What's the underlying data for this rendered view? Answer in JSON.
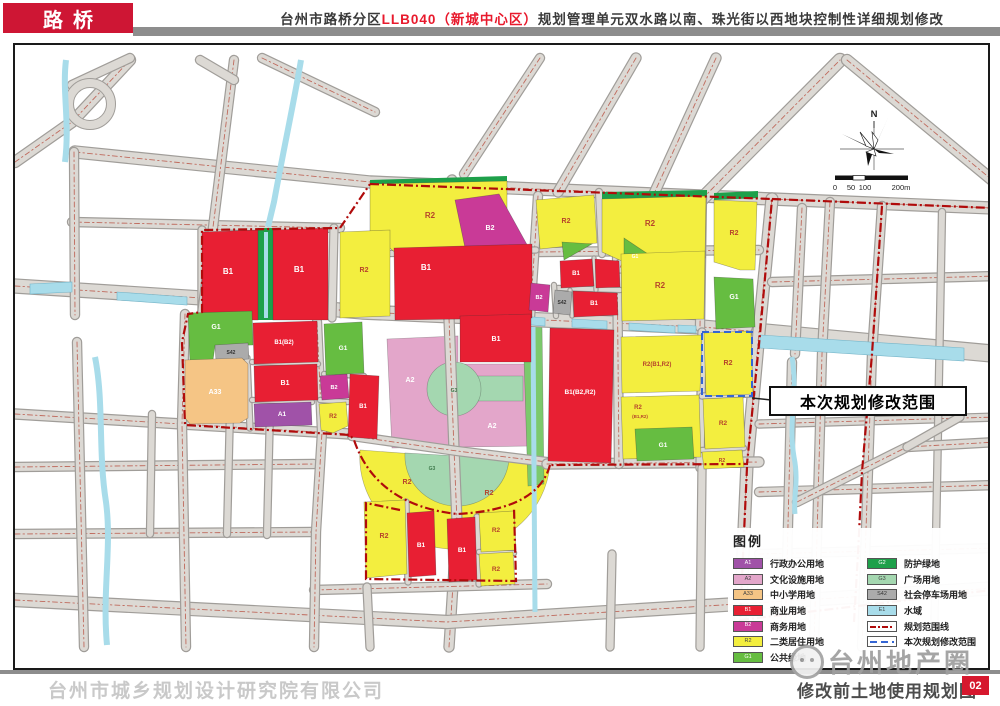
{
  "header": {
    "district": "路桥",
    "title_part1": "台州市路桥分区",
    "title_red": "LLB040（新城中心区）",
    "title_part2": "规划管理单元双水路以南、珠光街以西地块控制性详细规划修改"
  },
  "annotation": {
    "callout": "本次规划修改范围"
  },
  "compass": {
    "label": "N"
  },
  "scalebar": {
    "labels": [
      "0",
      "50",
      "100",
      "200m"
    ]
  },
  "legend": {
    "title": "图例",
    "left": [
      {
        "code": "A1",
        "label": "行政办公用地",
        "color": "#a052a8",
        "tc": "#ffffff",
        "type": "swatch"
      },
      {
        "code": "A2",
        "label": "文化设施用地",
        "color": "#e3a6ca",
        "tc": "#444444",
        "type": "swatch"
      },
      {
        "code": "A33",
        "label": "中小学用地",
        "color": "#f5c585",
        "tc": "#444444",
        "type": "swatch"
      },
      {
        "code": "B1",
        "label": "商业用地",
        "color": "#e81f33",
        "tc": "#ffffff",
        "type": "swatch"
      },
      {
        "code": "B2",
        "label": "商务用地",
        "color": "#c93a97",
        "tc": "#ffffff",
        "type": "swatch"
      },
      {
        "code": "R2",
        "label": "二类居住用地",
        "color": "#f3ee3f",
        "tc": "#444444",
        "type": "swatch"
      },
      {
        "code": "G1",
        "label": "公共绿地",
        "color": "#66bd41",
        "tc": "#ffffff",
        "type": "swatch"
      }
    ],
    "right": [
      {
        "code": "G2",
        "label": "防护绿地",
        "color": "#1ea04a",
        "tc": "#ffffff",
        "type": "swatch"
      },
      {
        "code": "G3",
        "label": "广场用地",
        "color": "#a4d7b0",
        "tc": "#444444",
        "type": "swatch"
      },
      {
        "code": "S42",
        "label": "社会停车场用地",
        "color": "#ababab",
        "tc": "#333333",
        "type": "swatch"
      },
      {
        "code": "E1",
        "label": "水域",
        "color": "#a8dcea",
        "tc": "#444444",
        "type": "swatch"
      },
      {
        "code": "",
        "label": "规划范围线",
        "color": "#ffffff",
        "tc": "#444444",
        "type": "line-red"
      },
      {
        "code": "",
        "label": "本次规划修改范围",
        "color": "#ffffff",
        "tc": "#444444",
        "type": "line-blue"
      }
    ]
  },
  "footer": {
    "company": "台州市城乡规划设计研究院有限公司",
    "watermark": "台州地产圈",
    "map_title": "修改前土地使用规划图",
    "page": "02"
  },
  "colors": {
    "A1": "#a052a8",
    "A2": "#e3a6ca",
    "A33": "#f5c585",
    "B1": "#e81f33",
    "B2": "#c93a97",
    "R2": "#f3ee3f",
    "G1": "#66bd41",
    "G2": "#1ea04a",
    "G3": "#a4d7b0",
    "S42": "#ababab",
    "E1": "#a8dcea",
    "roadFill": "#dcd9d4",
    "roadEdge": "#a09d99",
    "centerline": "#bf6a5d",
    "boundary": "#b00b0b",
    "modifyBlue": "#3465d4",
    "riverGreen": "#7cc96c"
  },
  "map": {
    "parks": [
      {
        "c": "A2",
        "pts": "385,337 456,334 456,362 529,362 529,444 390,446"
      },
      {
        "c": "G3",
        "path": "M452,374 L521,374 L521,399 L452,399 Z"
      },
      {
        "c": "G3",
        "circle": [
          452,
          387,
          27
        ]
      },
      {
        "c": "R2",
        "path": "M358,448 A95,92 0 0 0 548,462 Z"
      },
      {
        "c": "G3",
        "path": "M403,451 A52,50 0 0 0 507,457 Z"
      },
      {
        "c": "riverGreen",
        "pts": "521,325 540,323 542,482 526,484"
      }
    ],
    "roads": [
      {
        "p": "73,150 368,180 770,197 990,206",
        "w": 11,
        "cl": 1
      },
      {
        "p": "13,284 200,296 360,310 700,325 758,330",
        "w": 13,
        "cl": 1
      },
      {
        "p": "758,330 995,352",
        "w": 16,
        "cl": 0
      },
      {
        "p": "770,197 757,330 745,462 738,620",
        "w": 11,
        "cl": 1
      },
      {
        "p": "450,178 443,310",
        "w": 9,
        "cl": 1
      },
      {
        "p": "447,316 452,447 455,520 447,645",
        "w": 9,
        "cl": 1
      },
      {
        "p": "13,598 445,620 995,586",
        "w": 12,
        "cl": 1
      },
      {
        "p": "700,197 838,58",
        "w": 12,
        "cl": 1
      },
      {
        "p": "845,58 995,182",
        "w": 10,
        "cl": 1
      },
      {
        "p": "70,220 338,226",
        "w": 8,
        "cl": 1
      },
      {
        "p": "536,250 757,248",
        "w": 8,
        "cl": 1
      },
      {
        "p": "13,412 180,422 348,432",
        "w": 9,
        "cl": 1
      },
      {
        "p": "350,434 455,449 545,460",
        "w": 8,
        "cl": 1
      },
      {
        "p": "545,462 757,460",
        "w": 9,
        "cl": 1
      },
      {
        "p": "617,385 702,383",
        "w": 7,
        "cl": 1
      },
      {
        "p": "13,465 312,462",
        "w": 8,
        "cl": 1
      },
      {
        "p": "13,532 310,530",
        "w": 8,
        "cl": 1
      },
      {
        "p": "312,588 545,582",
        "w": 8,
        "cl": 1
      },
      {
        "p": "757,552 995,546",
        "w": 8,
        "cl": 1
      },
      {
        "p": "757,490 995,483",
        "w": 8,
        "cl": 1
      },
      {
        "p": "770,280 995,274",
        "w": 8,
        "cl": 1
      },
      {
        "p": "757,422 995,415",
        "w": 7,
        "cl": 1
      },
      {
        "p": "72,150 73,313",
        "w": 8,
        "cl": 1
      },
      {
        "p": "75,340 82,645",
        "w": 8,
        "cl": 1
      },
      {
        "p": "200,228 200,310",
        "w": 7,
        "cl": 0
      },
      {
        "p": "183,312 180,422 184,645",
        "w": 8,
        "cl": 1
      },
      {
        "p": "315,320 320,430 314,530 312,645",
        "w": 8,
        "cl": 1
      },
      {
        "p": "332,226 330,316",
        "w": 7,
        "cl": 0
      },
      {
        "p": "365,585 368,645",
        "w": 7,
        "cl": 0
      },
      {
        "p": "536,194 528,316",
        "w": 8,
        "cl": 1
      },
      {
        "p": "597,190 600,252",
        "w": 6,
        "cl": 0
      },
      {
        "p": "615,250 617,462",
        "w": 8,
        "cl": 1
      },
      {
        "p": "700,194 698,325",
        "w": 8,
        "cl": 1
      },
      {
        "p": "700,330 698,466",
        "w": 7,
        "cl": 0
      },
      {
        "p": "800,206 793,352",
        "w": 8,
        "cl": 1
      },
      {
        "p": "790,360 783,645",
        "w": 8,
        "cl": 1
      },
      {
        "p": "828,200 820,352 812,645",
        "w": 8,
        "cl": 1
      },
      {
        "p": "880,204 870,352 860,645",
        "w": 8,
        "cl": 1
      },
      {
        "p": "940,210 932,645",
        "w": 6,
        "cl": 0
      },
      {
        "p": "232,58 200,313",
        "w": 8,
        "cl": 1
      },
      {
        "p": "13,160 70,120 128,58",
        "w": 10,
        "cl": 1
      },
      {
        "p": "128,56 70,83",
        "w": 8,
        "cl": 0
      },
      {
        "p": "198,58 232,78",
        "w": 8,
        "cl": 0
      },
      {
        "p": "260,56 373,110",
        "w": 8,
        "cl": 1
      },
      {
        "p": "538,56 462,172",
        "w": 8,
        "cl": 1
      },
      {
        "p": "634,56 556,190",
        "w": 9,
        "cl": 1
      },
      {
        "p": "714,56 618,266",
        "w": 9,
        "cl": 1
      },
      {
        "p": "795,500 905,445 995,440",
        "w": 8,
        "cl": 1
      },
      {
        "p": "905,445 958,415",
        "w": 7,
        "cl": 0
      },
      {
        "p": "150,412 148,532",
        "w": 6,
        "cl": 0
      },
      {
        "p": "228,408 225,532",
        "w": 6,
        "cl": 0
      },
      {
        "p": "268,408 265,533",
        "w": 6,
        "cl": 0
      },
      {
        "p": "610,552 608,645",
        "w": 7,
        "cl": 0
      },
      {
        "p": "700,466 698,645",
        "w": 7,
        "cl": 0
      },
      {
        "p": "368,252 534,248",
        "w": 5,
        "cl": 0
      },
      {
        "p": "245,356 248,426",
        "w": 5,
        "cl": 0
      },
      {
        "p": "250,360 316,362",
        "w": 4,
        "cl": 0
      },
      {
        "p": "250,398 310,400",
        "w": 4,
        "cl": 0
      },
      {
        "p": "318,398 346,400",
        "w": 4,
        "cl": 0
      },
      {
        "p": "322,372 362,374",
        "w": 4,
        "cl": 0
      },
      {
        "p": "556,286 618,288",
        "w": 4,
        "cl": 0
      },
      {
        "p": "552,283 554,314",
        "w": 4,
        "cl": 0
      },
      {
        "p": "592,256 594,288",
        "w": 3,
        "cl": 0
      },
      {
        "p": "568,288 570,314",
        "w": 3,
        "cl": 0
      },
      {
        "p": "700,394 750,392",
        "w": 5,
        "cl": 0
      },
      {
        "p": "700,448 742,446",
        "w": 4,
        "cl": 0
      },
      {
        "p": "404,500 406,580",
        "w": 5,
        "cl": 0
      },
      {
        "p": "475,515 477,582",
        "w": 5,
        "cl": 0
      },
      {
        "p": "477,550 512,551",
        "w": 4,
        "cl": 0
      }
    ],
    "loop": {
      "circle": [
        88,
        102,
        21
      ],
      "w": 8
    },
    "greens": [
      {
        "pts": "256,226 271,226 271,318 256,318"
      },
      {
        "pts": "368,178 505,174 505,182 368,186"
      },
      {
        "pts": "450,191 457,190 462,257 454,259"
      },
      {
        "pts": "600,190 705,188 705,195 600,197"
      },
      {
        "pts": "712,191 756,189 756,196 712,198"
      }
    ],
    "waterStrips": [
      "28,282 70,280 70,290 28,292",
      "115,290 185,295 185,303 115,298",
      "205,296 253,300 253,307 205,303",
      "408,305 445,308 445,316 408,313",
      "483,311 543,316 543,324 483,319",
      "570,317 605,319 605,327 570,325",
      "627,321 673,324 673,331 627,328",
      "676,323 694,324 694,331 676,330",
      "758,333 962,346 962,359 758,346"
    ],
    "canals": [
      {
        "d": "M299,58 C292,100 283,140 272,200 L266,225",
        "w": 6
      },
      {
        "d": "M264,230 L264,316",
        "w": 4
      },
      {
        "d": "M93,355 C102,400 96,450 104,500 C110,545 100,590 105,643",
        "w": 6
      },
      {
        "d": "M531,325 L533,610",
        "w": 5
      },
      {
        "d": "M790,355 C796,390 786,420 792,455 C797,480 791,495 793,512",
        "w": 5
      },
      {
        "d": "M64,58 C60,90 68,120 63,160",
        "w": 6
      }
    ],
    "blocks": [
      {
        "c": "R2",
        "pts": "368,182 505,179 505,254 400,256 368,230",
        "L": [
          [
            "R2",
            428,
            216,
            8
          ]
        ]
      },
      {
        "c": "B2",
        "pts": "453,198 497,192 528,248 510,260 466,260",
        "L": [
          [
            "B2",
            488,
            228,
            7
          ]
        ]
      },
      {
        "c": "R2",
        "pts": "534,198 592,193 595,241 538,247",
        "L": [
          [
            "R2",
            564,
            221,
            7
          ]
        ]
      },
      {
        "c": "R2",
        "pts": "600,197 704,194 703,256 660,260 622,260 600,250",
        "L": [
          [
            "R2",
            648,
            224,
            8
          ]
        ]
      },
      {
        "c": "G1",
        "pts": "622,236 658,260 622,260",
        "L": [
          [
            "G1",
            633,
            256,
            5
          ]
        ]
      },
      {
        "c": "R2",
        "pts": "712,198 755,200 753,268 738,268 712,260",
        "L": [
          [
            "R2",
            732,
            233,
            7
          ]
        ]
      },
      {
        "c": "G1",
        "pts": "712,275 751,277 753,325 714,327",
        "L": [
          [
            "G1",
            732,
            297,
            7
          ]
        ]
      },
      {
        "c": "B1",
        "pts": "200,230 256,228 256,318 200,318",
        "L": [
          [
            "B1",
            226,
            272,
            8
          ]
        ]
      },
      {
        "c": "B1",
        "pts": "271,228 326,226 326,318 271,318",
        "L": [
          [
            "B1",
            297,
            270,
            8
          ]
        ]
      },
      {
        "c": "R2",
        "pts": "338,230 388,228 388,314 338,316",
        "L": [
          [
            "R2",
            362,
            270,
            7
          ]
        ]
      },
      {
        "c": "B1",
        "pts": "392,246 530,242 530,316 393,318",
        "L": [
          [
            "B1",
            424,
            268,
            8
          ]
        ]
      },
      {
        "c": "G1",
        "pts": "560,240 590,242 562,258",
        "L": []
      },
      {
        "c": "B1",
        "pts": "558,259 590,257 592,284 559,286",
        "L": [
          [
            "B1",
            574,
            273,
            6
          ]
        ]
      },
      {
        "c": "B1",
        "pts": "593,257 617,259 618,285 594,286",
        "L": []
      },
      {
        "c": "B2",
        "pts": "529,281 548,283 546,310 527,308",
        "L": [
          [
            "B2",
            537,
            297,
            5.5
          ]
        ]
      },
      {
        "c": "S42",
        "pts": "553,288 570,290 568,313 551,311",
        "L": [
          [
            "S42",
            560,
            302,
            5,
            "#333333"
          ]
        ]
      },
      {
        "c": "B1",
        "pts": "571,289 615,291 616,313 572,315",
        "L": [
          [
            "B1",
            592,
            303,
            6
          ]
        ]
      },
      {
        "c": "B1",
        "pts": "548,326 612,328 609,461 546,459",
        "L": [
          [
            "B1(B2,R2)",
            578,
            392,
            6.5
          ]
        ]
      },
      {
        "c": "G1",
        "pts": "186,311 250,309 251,343 213,344 211,358 188,360",
        "L": [
          [
            "G1",
            214,
            327,
            7
          ]
        ]
      },
      {
        "c": "S42",
        "pts": "213,343 246,341 247,357 214,359",
        "L": [
          [
            "S42",
            229,
            352,
            5,
            "#333333"
          ]
        ]
      },
      {
        "c": "B1",
        "pts": "251,321 315,319 316,360 252,362",
        "L": [
          [
            "B1(B2)",
            282,
            342,
            6
          ]
        ]
      },
      {
        "c": "B1",
        "pts": "252,364 315,362 316,398 253,400",
        "L": [
          [
            "B1",
            283,
            383,
            7
          ]
        ]
      },
      {
        "c": "A33",
        "pts": "183,358 240,356 246,362 246,416 238,421 188,422 183,416",
        "L": [
          [
            "A33",
            213,
            392,
            7,
            "#ffffff"
          ]
        ]
      },
      {
        "c": "A1",
        "pts": "252,402 309,400 310,423 253,425",
        "L": [
          [
            "A1",
            280,
            414,
            6.5
          ]
        ]
      },
      {
        "c": "B2",
        "pts": "318,374 345,372 347,396 320,398",
        "L": [
          [
            "B2",
            332,
            387,
            5.5
          ]
        ]
      },
      {
        "c": "R2",
        "pts": "317,402 344,400 346,424 331,431 319,428",
        "L": [
          [
            "R2",
            331,
            416,
            6
          ]
        ]
      },
      {
        "c": "G1",
        "pts": "322,322 360,320 362,371 324,373",
        "L": [
          [
            "G1",
            341,
            348,
            6.5
          ]
        ]
      },
      {
        "c": "B1",
        "pts": "348,372 377,374 375,437 346,435",
        "L": [
          [
            "B1",
            361,
            406,
            6
          ]
        ]
      },
      {
        "c": "B1",
        "pts": "458,314 529,312 529,360 458,360",
        "L": [
          [
            "B1",
            494,
            339,
            7
          ]
        ]
      },
      {
        "c": "R2",
        "pts": "362,500 403,498 405,572 364,576",
        "L": [
          [
            "R2",
            382,
            536,
            7
          ]
        ]
      },
      {
        "c": "B1",
        "pts": "405,511 432,509 434,573 407,575",
        "L": [
          [
            "B1",
            419,
            545,
            6.5
          ]
        ]
      },
      {
        "c": "B1",
        "pts": "445,517 473,515 475,578 447,580",
        "L": [
          [
            "B1",
            460,
            550,
            6.5
          ]
        ]
      },
      {
        "c": "R2",
        "pts": "477,511 512,509 514,548 479,550",
        "L": [
          [
            "R2",
            494,
            530,
            6.5
          ]
        ]
      },
      {
        "c": "R2",
        "pts": "477,552 511,550 513,582 479,584",
        "L": [
          [
            "R2",
            494,
            569,
            6.5
          ]
        ]
      },
      {
        "c": "R2",
        "pts": "619,252 703,249 702,317 620,319",
        "L": [
          [
            "R2",
            658,
            286,
            8
          ]
        ]
      },
      {
        "c": "R2",
        "pts": "619,335 700,333 698,389 620,391",
        "L": [
          [
            "R2(B1,R2)",
            655,
            364,
            6
          ]
        ]
      },
      {
        "c": "R2",
        "pts": "702,331 749,329 751,392 704,394",
        "L": [
          [
            "R2",
            726,
            363,
            7
          ]
        ]
      },
      {
        "c": "R2",
        "pts": "619,395 697,393 699,455 621,457",
        "L": [
          [
            "R2",
            636,
            407,
            6
          ],
          [
            "(B1,R2)",
            638,
            416,
            4.5
          ]
        ]
      },
      {
        "c": "G1",
        "pts": "633,427 690,425 692,457 635,459",
        "L": [
          [
            "G1",
            661,
            445,
            6.5
          ]
        ]
      },
      {
        "c": "R2",
        "pts": "701,397 741,395 743,445 703,447",
        "L": [
          [
            "R2",
            721,
            423,
            6.5
          ]
        ]
      },
      {
        "c": "R2",
        "pts": "700,450 740,448 742,465 702,467",
        "L": [
          [
            "R2",
            720,
            460,
            5
          ]
        ]
      }
    ],
    "parkLabels": [
      [
        "A2",
        408,
        380,
        7,
        "#ffffff"
      ],
      [
        "A2",
        490,
        426,
        7,
        "#ffffff"
      ],
      [
        "G3",
        452,
        390,
        5,
        "#3f7a4c"
      ],
      [
        "R2",
        405,
        482,
        7,
        "#b6442b"
      ],
      [
        "R2",
        487,
        493,
        7,
        "#b6442b"
      ],
      [
        "G3",
        430,
        468,
        5,
        "#3f7a4c"
      ]
    ],
    "boundary": [
      "M368,182 L770,197 L758,332 L745,462 L548,463",
      "M548,463 Q536,508 455,512 Q374,503 352,438 L348,433 L183,423 L180,340 L186,312 L200,310 L200,228 L338,226 L368,182",
      "M398,508 L364,501 L364,577 L514,579 L512,506",
      "M770,197 L990,206",
      "M880,204 L870,352 L860,470 L856,552 L852,620",
      "M745,465 L738,620",
      "M738,618 L990,588"
    ],
    "modifyRect": {
      "x": 700,
      "y": 330,
      "w": 50,
      "h": 64
    },
    "leader": "M750,396 L769,398"
  }
}
